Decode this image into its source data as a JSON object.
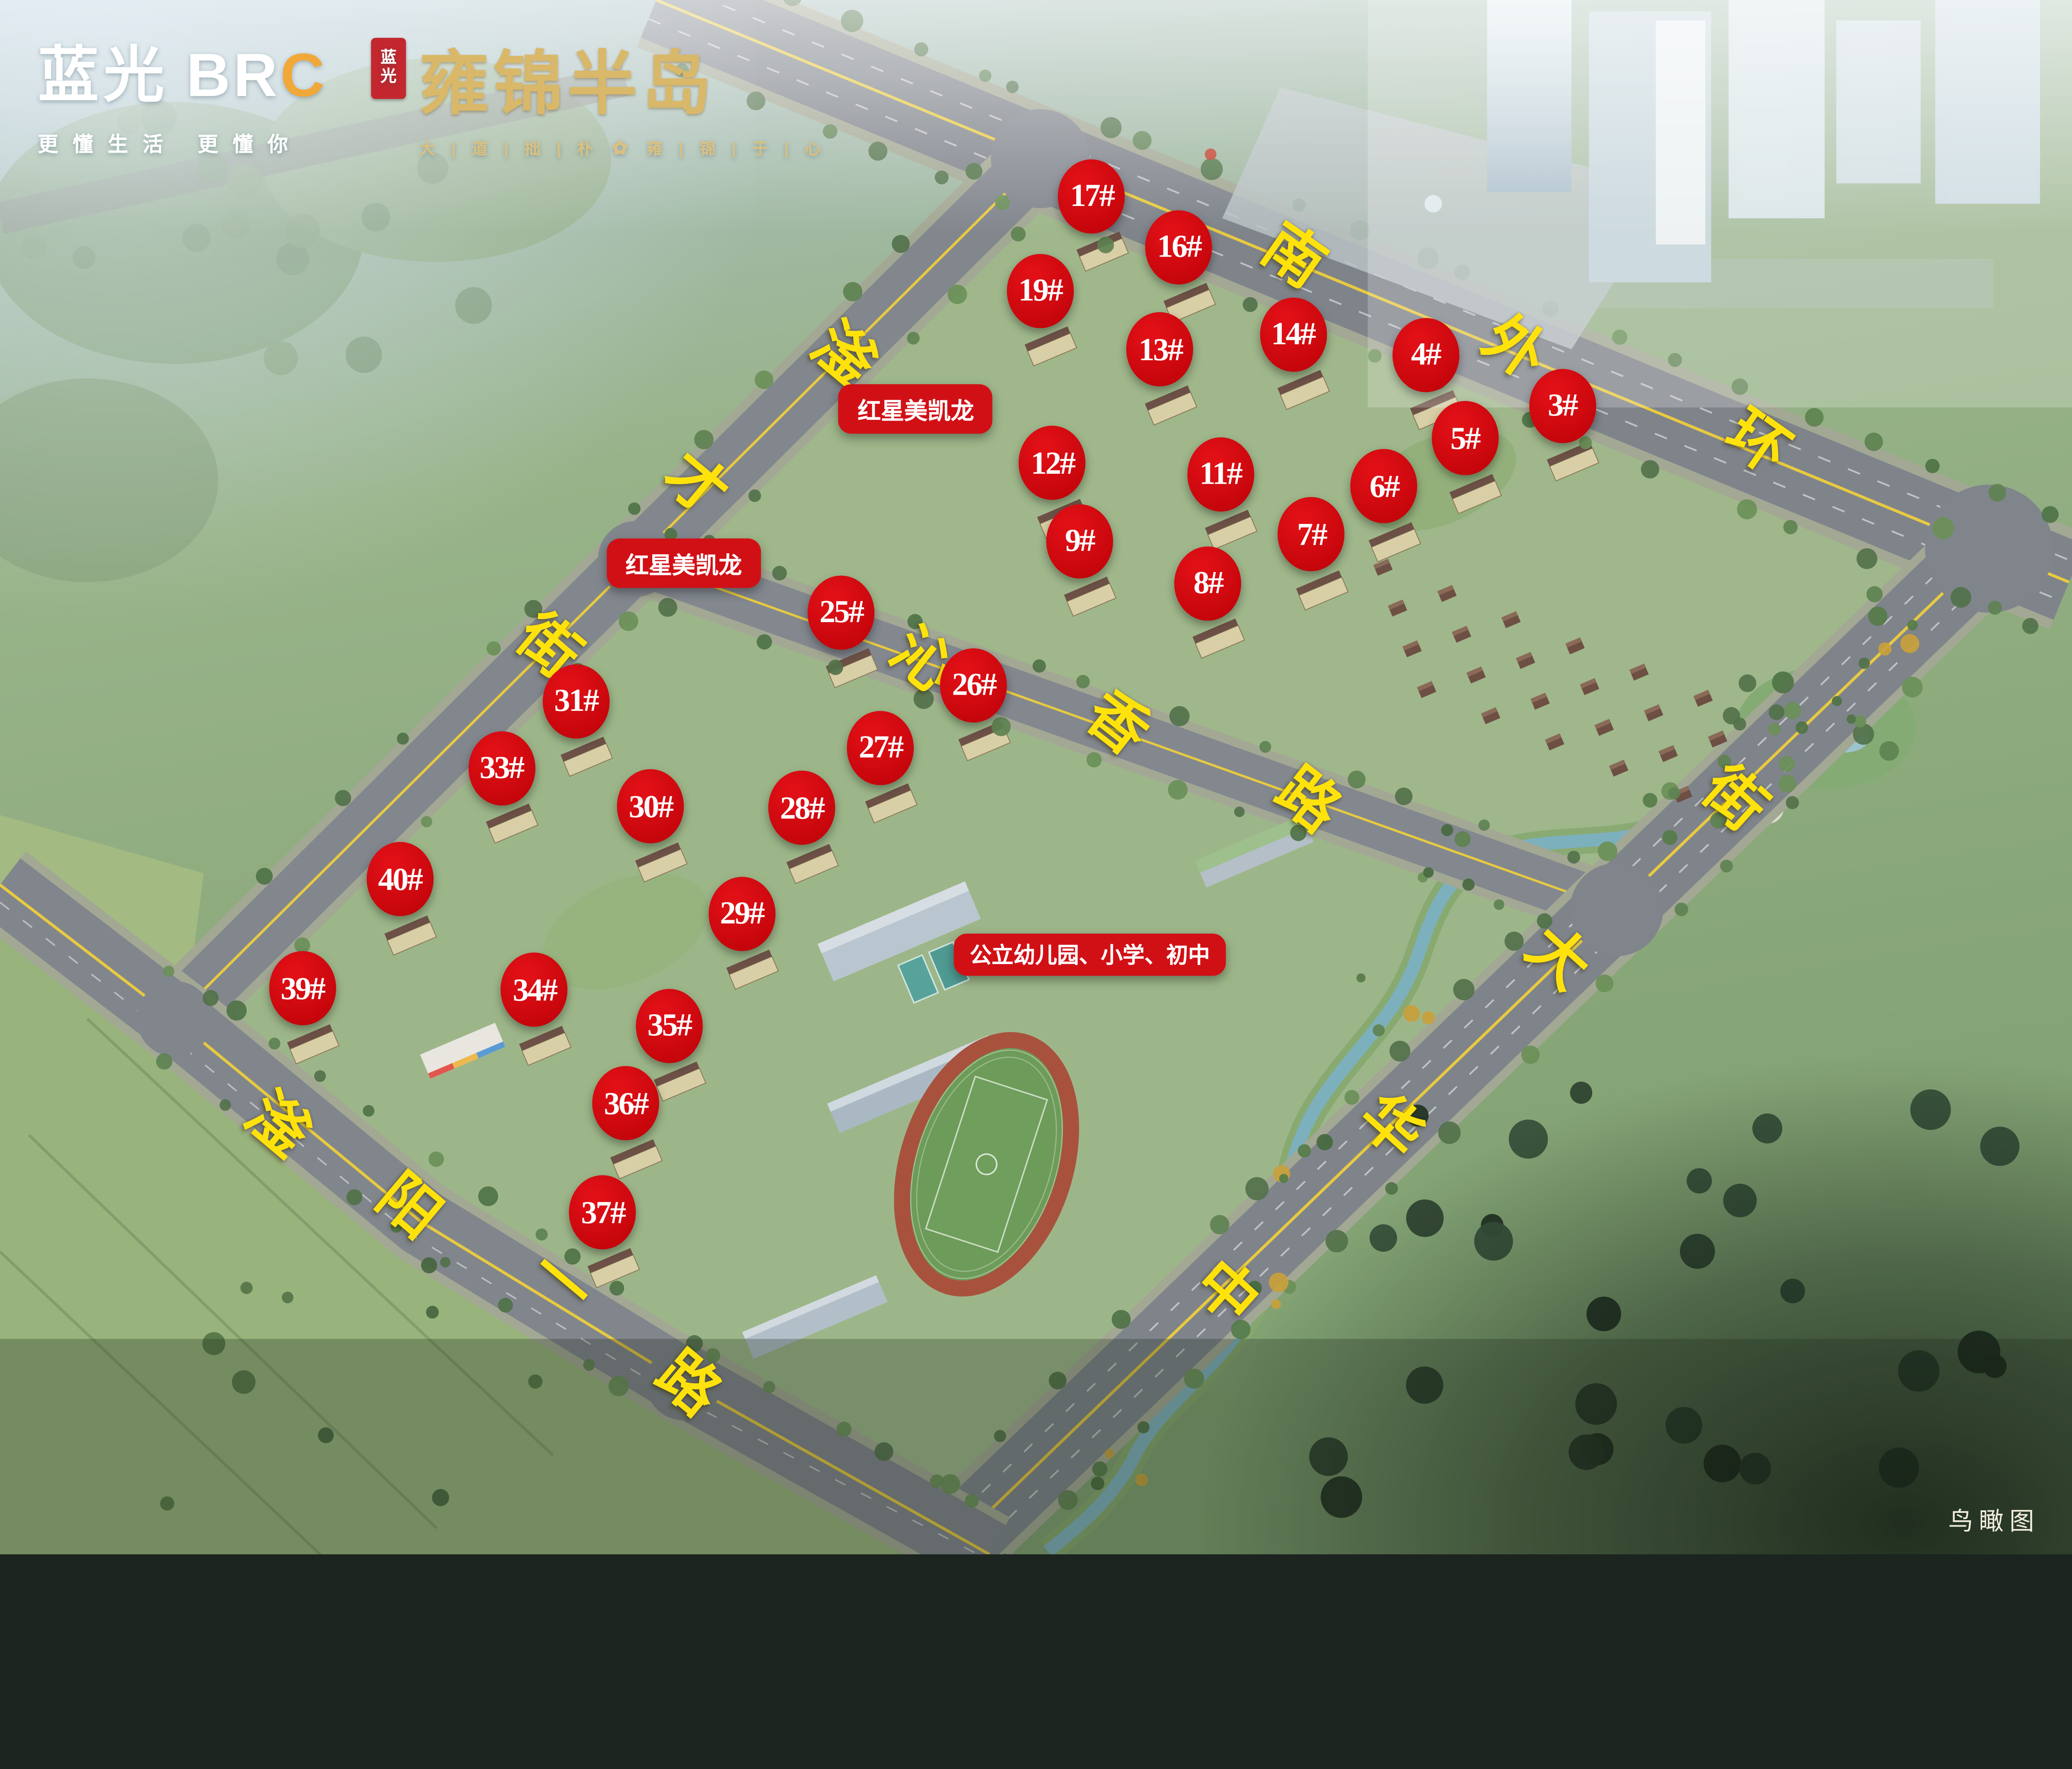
{
  "meta": {
    "caption": "鸟瞰图"
  },
  "branding": {
    "developer_logo": {
      "cn": "蓝光",
      "en_prefix": "BR",
      "en_accent": "C",
      "tagline": "更懂生活  更懂你"
    },
    "project_logo": {
      "seal_top": "蓝",
      "seal_bottom": "光",
      "name": "雍锦半岛",
      "slogan_left": "大 | 道 | 拙 | 朴",
      "slogan_right": "雍 | 锦 | 于 | 心",
      "flower_icon": "✿"
    }
  },
  "map_labels": {
    "poi": [
      {
        "id": "hongxing-north",
        "text": "红星美凯龙",
        "x": 44.2,
        "y": 26.3,
        "small": false
      },
      {
        "id": "hongxing-west",
        "text": "红星美凯龙",
        "x": 33.0,
        "y": 36.2,
        "small": false
      },
      {
        "id": "school",
        "text": "公立幼儿园、小学、初中",
        "x": 52.6,
        "y": 61.4,
        "small": true
      }
    ],
    "roads": [
      {
        "name": "南外环",
        "rotation": 35,
        "chars": [
          {
            "c": "南",
            "x": 62.4,
            "y": 16.5
          },
          {
            "c": "外",
            "x": 73.1,
            "y": 22.4
          },
          {
            "c": "环",
            "x": 84.8,
            "y": 28.5
          }
        ]
      },
      {
        "name": "滏才街",
        "rotation": 40,
        "chars": [
          {
            "c": "滏",
            "x": 40.7,
            "y": 22.8
          },
          {
            "c": "才",
            "x": 33.6,
            "y": 31.2
          },
          {
            "c": "街",
            "x": 26.5,
            "y": 41.6
          }
        ]
      },
      {
        "name": "沁香路",
        "rotation": 38,
        "chars": [
          {
            "c": "沁",
            "x": 44.5,
            "y": 42.5
          },
          {
            "c": "香",
            "x": 53.9,
            "y": 46.5
          },
          {
            "c": "路",
            "x": 63.1,
            "y": 51.5
          }
        ]
      },
      {
        "name": "中华大街",
        "rotation": 42,
        "chars": [
          {
            "c": "中",
            "x": 59.2,
            "y": 83.1
          },
          {
            "c": "华",
            "x": 67.1,
            "y": 72.5
          },
          {
            "c": "大",
            "x": 75.2,
            "y": 61.6
          },
          {
            "c": "街",
            "x": 83.7,
            "y": 51.4
          }
        ]
      },
      {
        "name": "滏阳一路",
        "rotation": 40,
        "chars": [
          {
            "c": "滏",
            "x": 13.4,
            "y": 72.4
          },
          {
            "c": "阳",
            "x": 19.7,
            "y": 77.6
          },
          {
            "c": "一",
            "x": 27.1,
            "y": 82.5
          },
          {
            "c": "路",
            "x": 33.2,
            "y": 89.0
          }
        ]
      }
    ],
    "buildings": [
      {
        "label": "17#",
        "x": 52.7,
        "y": 12.6
      },
      {
        "label": "16#",
        "x": 56.9,
        "y": 15.9
      },
      {
        "label": "19#",
        "x": 50.2,
        "y": 18.7
      },
      {
        "label": "13#",
        "x": 56.0,
        "y": 22.5
      },
      {
        "label": "14#",
        "x": 62.4,
        "y": 21.5
      },
      {
        "label": "4#",
        "x": 68.8,
        "y": 22.8
      },
      {
        "label": "3#",
        "x": 75.4,
        "y": 26.1
      },
      {
        "label": "5#",
        "x": 70.7,
        "y": 28.2
      },
      {
        "label": "12#",
        "x": 50.8,
        "y": 29.8
      },
      {
        "label": "11#",
        "x": 58.9,
        "y": 30.5
      },
      {
        "label": "6#",
        "x": 66.8,
        "y": 31.3
      },
      {
        "label": "9#",
        "x": 52.1,
        "y": 34.8
      },
      {
        "label": "7#",
        "x": 63.3,
        "y": 34.4
      },
      {
        "label": "8#",
        "x": 58.3,
        "y": 37.5
      },
      {
        "label": "25#",
        "x": 40.6,
        "y": 39.4
      },
      {
        "label": "26#",
        "x": 47.0,
        "y": 44.1
      },
      {
        "label": "31#",
        "x": 27.8,
        "y": 45.1
      },
      {
        "label": "27#",
        "x": 42.5,
        "y": 48.1
      },
      {
        "label": "33#",
        "x": 24.2,
        "y": 49.4
      },
      {
        "label": "30#",
        "x": 31.4,
        "y": 51.9
      },
      {
        "label": "28#",
        "x": 38.7,
        "y": 52.0
      },
      {
        "label": "40#",
        "x": 19.3,
        "y": 56.6
      },
      {
        "label": "29#",
        "x": 35.8,
        "y": 58.8
      },
      {
        "label": "39#",
        "x": 14.6,
        "y": 63.6
      },
      {
        "label": "34#",
        "x": 25.8,
        "y": 63.7
      },
      {
        "label": "35#",
        "x": 32.3,
        "y": 66.0
      },
      {
        "label": "36#",
        "x": 30.2,
        "y": 71.0
      },
      {
        "label": "37#",
        "x": 29.1,
        "y": 78.0
      }
    ]
  },
  "colors": {
    "marker_red": "#c3050b",
    "label_red": "#d11016",
    "road_yellow": "#ffe20c",
    "center_line_yellow": "#e8ca40",
    "logo_gold": "#d9b869"
  }
}
